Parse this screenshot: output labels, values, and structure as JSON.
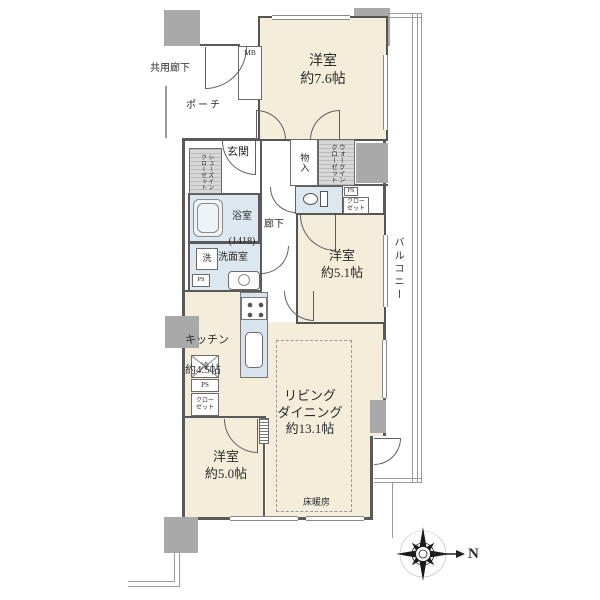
{
  "plan": {
    "common_corridor": "共用廊下",
    "porch": "ポーチ",
    "meter_box": "MB",
    "entrance": "玄関",
    "shoes_closet": "シューズイン\nクローゼット",
    "storage": "物入",
    "walk_in_closet": "ウォークイン\nクローゼット",
    "bathroom_name": "浴室",
    "bathroom_size": "(1418)",
    "corridor": "廊下",
    "laundry": "洗",
    "washroom": "洗面室",
    "pipe_space": "PS",
    "closet": "クロー\nゼット",
    "refrigerator": "冷",
    "floor_heating": "床暖房",
    "balcony": "バルコニー",
    "rooms": {
      "west76": {
        "name": "洋室",
        "size": "約7.6帖"
      },
      "west51": {
        "name": "洋室",
        "size": "約5.1帖"
      },
      "west50": {
        "name": "洋室",
        "size": "約5.0帖"
      },
      "living": {
        "name": "リビング\nダイニング",
        "size": "約13.1帖"
      },
      "kitchen": {
        "name": "キッチン",
        "size": "約4.5帖"
      }
    }
  },
  "compass": {
    "north": "N"
  },
  "colors": {
    "room_fill": "#f4edda",
    "wet_fill": "#dce7f0",
    "pillar": "#a9a9a9",
    "wall": "#5a5a5a"
  }
}
